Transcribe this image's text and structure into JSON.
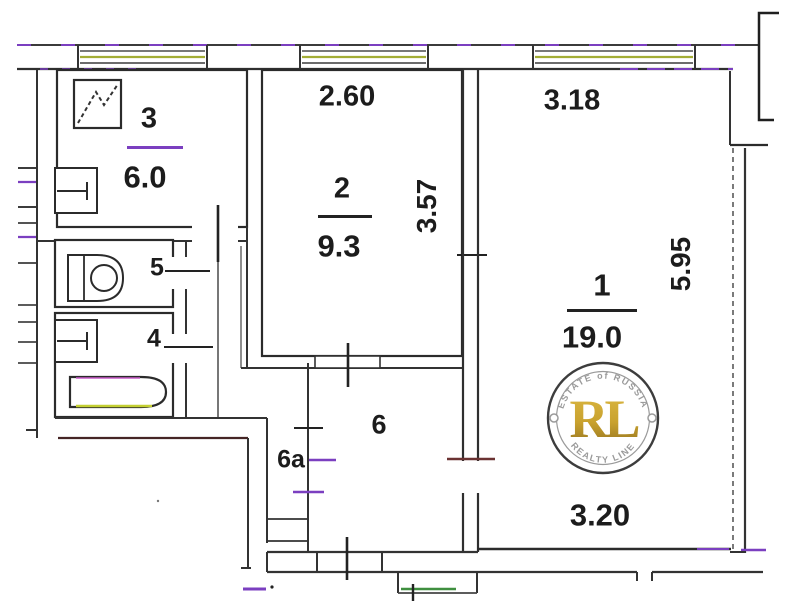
{
  "plan_labels": {
    "room1_number": "1",
    "room1_area": "19.0",
    "room2_number": "2",
    "room2_area": "9.3",
    "room3_number": "3",
    "room3_area": "6.0",
    "room4_number": "4",
    "room5_number": "5",
    "room6_number": "6",
    "room6a_number": "6a"
  },
  "dimensions": {
    "room2_width": "2.60",
    "room1_width": "3.18",
    "room2_depth": "3.57",
    "room1_depth": "5.95",
    "room1_width_bottom": "3.20"
  },
  "watermark": {
    "arc_top": "ESTATE of RUSSIA",
    "monogram": "RL",
    "arc_bottom": "REALTY LINE"
  },
  "colors": {
    "line": "#2c2c2c",
    "accent_purple": "#7b3fc0",
    "accent_yellow_green": "#a3ad35",
    "accent_green": "#3f8f3f",
    "accent_maroon": "#6b3232",
    "accent_magenta": "#c75bc7",
    "watermark_gold": "#c9a22e",
    "watermark_gray": "#9a9a9a"
  },
  "icons": "stove-icon, kitchen-sink-icon, toilet-icon, washbasin-icon, bathtub-icon, window-icon, door-tick-marker"
}
